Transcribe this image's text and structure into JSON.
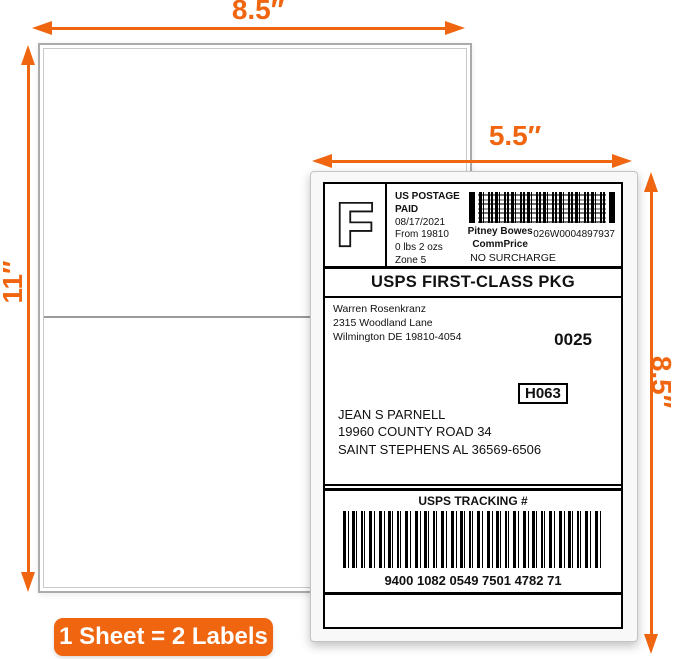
{
  "annotations": {
    "sheet_width": "8.5″",
    "sheet_height": "11″",
    "label_width": "5.5″",
    "label_height": "8.5″",
    "badge_text": "1 Sheet = 2 Labels",
    "accent_color": "#F0650F"
  },
  "icons": {
    "dimension_arrows": "double-headed-arrow",
    "postage_meter_barcode": "2d-matrix-barcode",
    "tracking_barcode": "1d-code128-barcode"
  },
  "shipping_label": {
    "stamp_letter": "F",
    "postage": {
      "paid_line1": "US POSTAGE",
      "paid_line2": "PAID",
      "date": "08/17/2021",
      "origin": "From 19810",
      "weight": "0 lbs 2 ozs",
      "zone": "Zone 5"
    },
    "carrier": {
      "name_line1": "Pitney Bowes",
      "name_line2": "CommPrice",
      "meter_number": "026W0004897937",
      "surcharge": "NO SURCHARGE"
    },
    "service": "USPS FIRST-CLASS PKG",
    "sender": {
      "name": "Warren Rosenkranz",
      "street": "2315 Woodland Lane",
      "city_state_zip": "Wilmington DE 19810-4054"
    },
    "batch_number": "0025",
    "sort_code": "H063",
    "recipient": {
      "name": "JEAN S PARNELL",
      "street": "19960 COUNTY ROAD 34",
      "city_state_zip": "SAINT STEPHENS AL 36569-6506"
    },
    "tracking": {
      "title": "USPS TRACKING #",
      "number": "9400 1082 0549 7501 4782 71"
    }
  }
}
